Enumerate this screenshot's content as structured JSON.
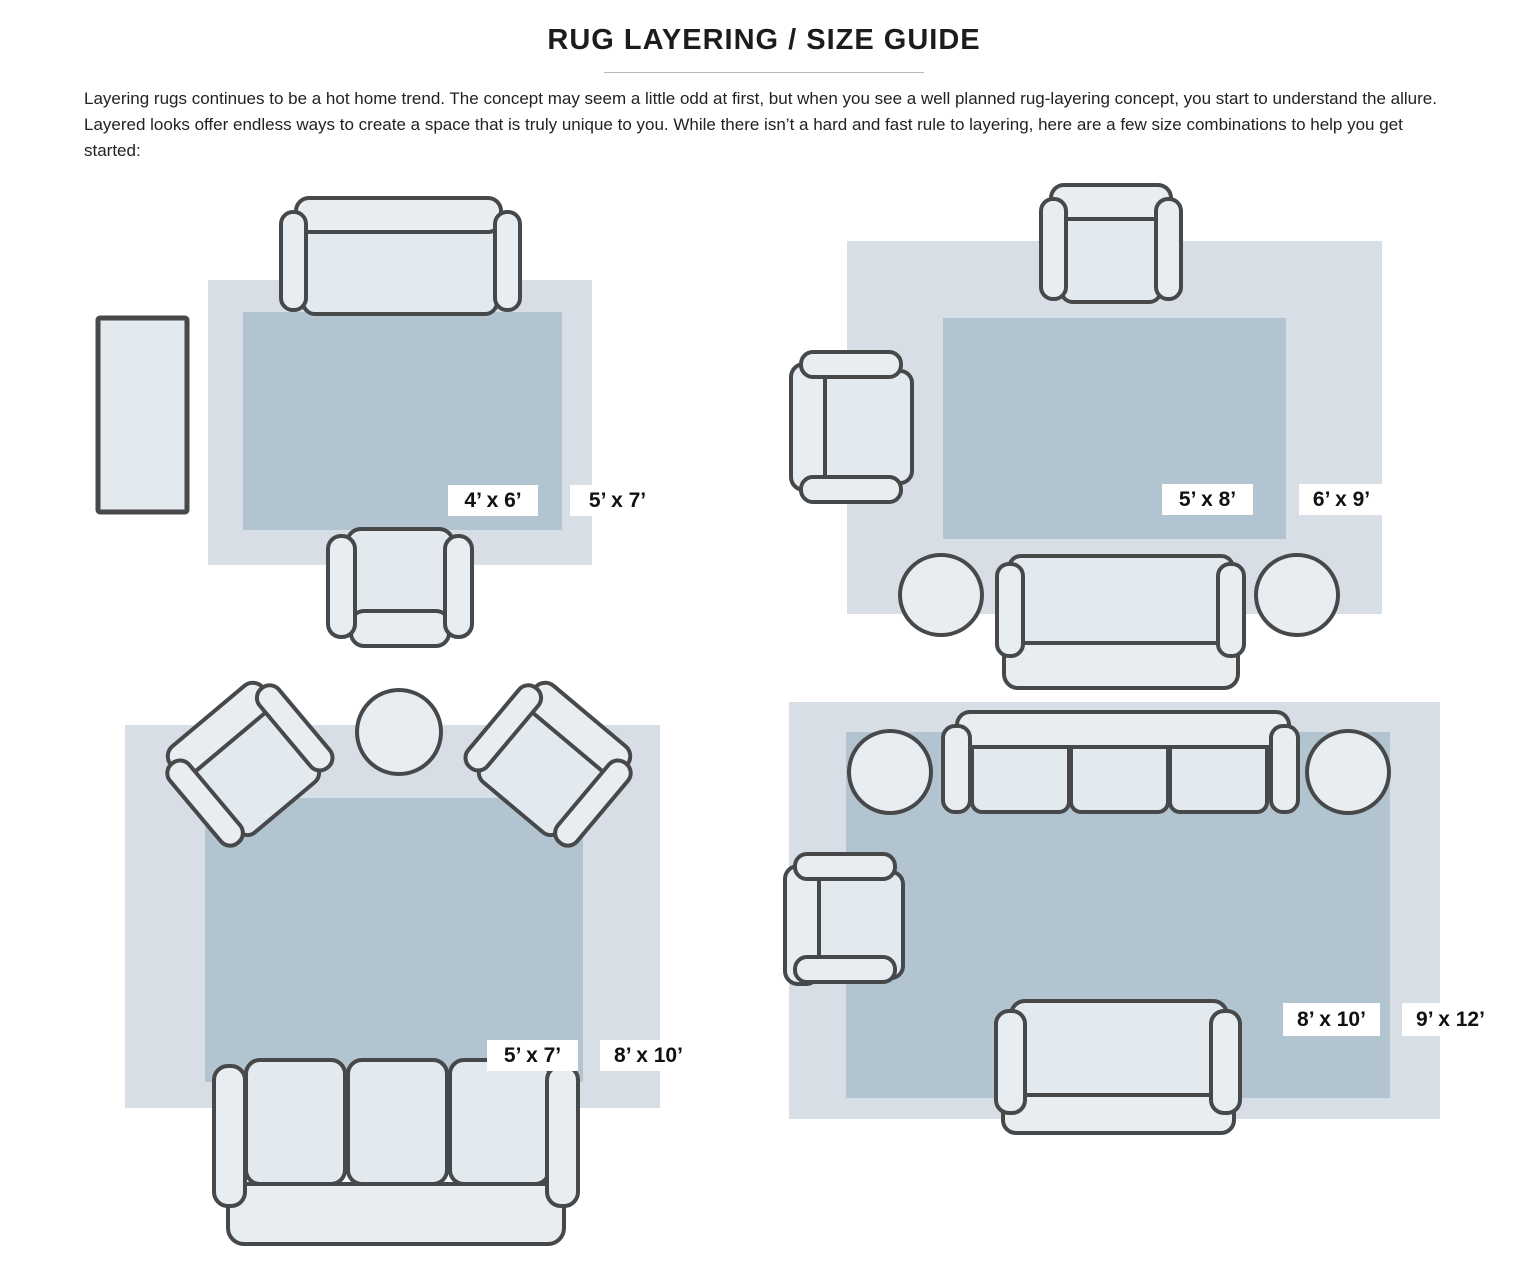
{
  "page": {
    "title": "RUG LAYERING / SIZE GUIDE",
    "intro": "Layering rugs continues to be a hot home trend. The concept may seem a little odd at first, but when you see a well planned rug-layering concept, you start to understand the allure. Layered looks offer endless ways to create a space that is truly unique to you. While there isn’t a hard and fast rule to layering, here are a few size combinations to help you get started:"
  },
  "colors": {
    "outer_rug": "#d8dee6",
    "inner_rug": "#b2c4d0",
    "furniture_fill": "#e8edf1",
    "furniture_outline": "#47484a",
    "label_bg": "#ffffff",
    "label_text": "#111111"
  },
  "diagrams": [
    {
      "position": "top-left",
      "inner_label": "4’ x 6’",
      "outer_label": "5’ x 7’",
      "furniture": [
        "sofa",
        "armchair",
        "side-table"
      ]
    },
    {
      "position": "top-right",
      "inner_label": "5’ x 8’",
      "outer_label": "6’ x 9’",
      "furniture": [
        "armchair",
        "armchair",
        "sofa",
        "round-side-table",
        "round-side-table"
      ]
    },
    {
      "position": "bottom-left",
      "inner_label": "5’ x 7’",
      "outer_label": "8’ x 10’",
      "furniture": [
        "angled-armchair",
        "angled-armchair",
        "round-side-table",
        "three-seat-sofa"
      ]
    },
    {
      "position": "bottom-right",
      "inner_label": "8’ x 10’",
      "outer_label": "9’ x 12’",
      "furniture": [
        "three-seat-sofa",
        "round-side-table",
        "round-side-table",
        "armchair",
        "loveseat"
      ]
    }
  ]
}
